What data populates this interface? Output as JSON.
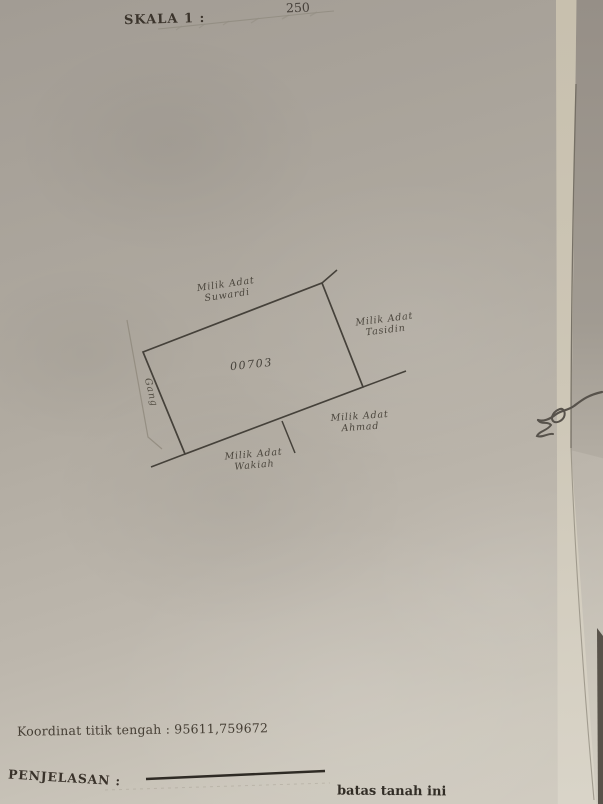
{
  "colors": {
    "paper": "#b1aba1",
    "ink": "#3a342c",
    "sketch_line": "#45413a",
    "legend_line": "#2f2b25"
  },
  "header": {
    "scale_label": "SKALA 1 :",
    "scale_value": "250"
  },
  "sketch": {
    "parcel_number": "00703",
    "labels": {
      "top_neighbor": {
        "line1": "Milik Adat",
        "line2": "Suwardi"
      },
      "right_neighbor": {
        "line1": "Milik Adat",
        "line2": "Tasidin"
      },
      "bottom_right_neighbor": {
        "line1": "Milik Adat",
        "line2": "Ahmad"
      },
      "bottom_neighbor": {
        "line1": "Milik Adat",
        "line2": "Wakiah"
      },
      "road": "Gang"
    }
  },
  "footer": {
    "coordinate_text": "Koordinat titik tengah : 95611,759672",
    "explanation_label": "PENJELASAN :",
    "legend_label": "batas tanah ini"
  }
}
